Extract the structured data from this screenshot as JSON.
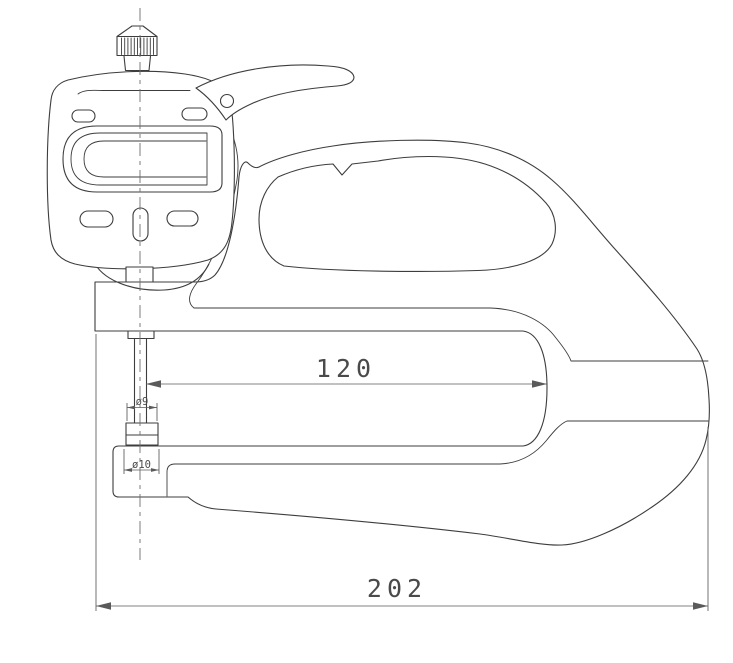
{
  "meta": {
    "background": "#ffffff",
    "line_color": "#3d3d3d",
    "dim_color": "#5a5a5a"
  },
  "dims": {
    "throat_depth": {
      "label": "120"
    },
    "overall_length": {
      "label": "202"
    },
    "upper_anvil": {
      "label": "ø9"
    },
    "lower_anvil": {
      "label": "ø10"
    }
  }
}
